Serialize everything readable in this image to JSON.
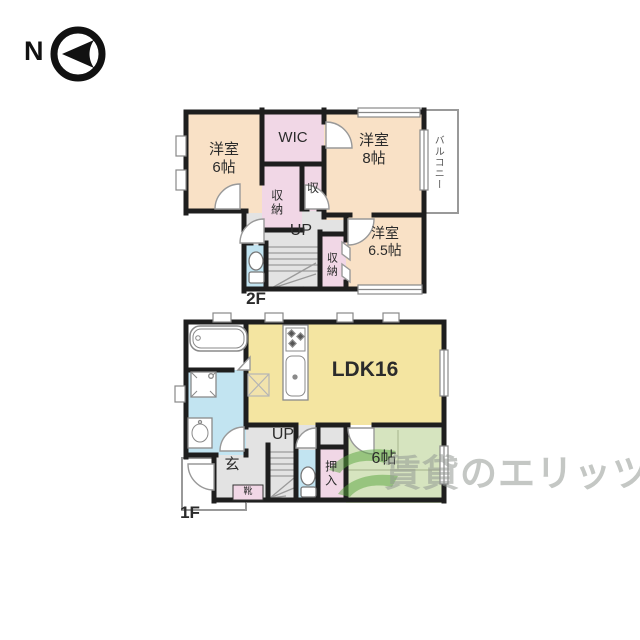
{
  "compass": {
    "label": "N"
  },
  "floor2": {
    "floor_label": "2F",
    "room_west6": "洋室\n6帖",
    "wic": "WIC",
    "closet_upper": "収納",
    "closet_small": "収",
    "room_west8": "洋室\n8帖",
    "balcony": "バルコニー",
    "stairs_up": "UP",
    "closet_lower": "収納",
    "room_west65": "洋室\n6.5帖"
  },
  "floor1": {
    "floor_label": "1F",
    "ldk": "LDK16",
    "stairs_up": "UP",
    "entrance": "玄",
    "shoe_cabinet": "靴",
    "closet": "押入",
    "tatami6": "6帖"
  },
  "watermark": {
    "text": "賃貸のエリッツ",
    "logo_color": "#5aa63f"
  },
  "colors": {
    "wall": "#1e1e1e",
    "room_peach": "#f9e1c6",
    "room_pink": "#f1d7e6",
    "room_yellow": "#f4e5a1",
    "room_green": "#d6e4bf",
    "room_blue": "#c2e4f1",
    "hall_gray": "#e3e3e3"
  }
}
